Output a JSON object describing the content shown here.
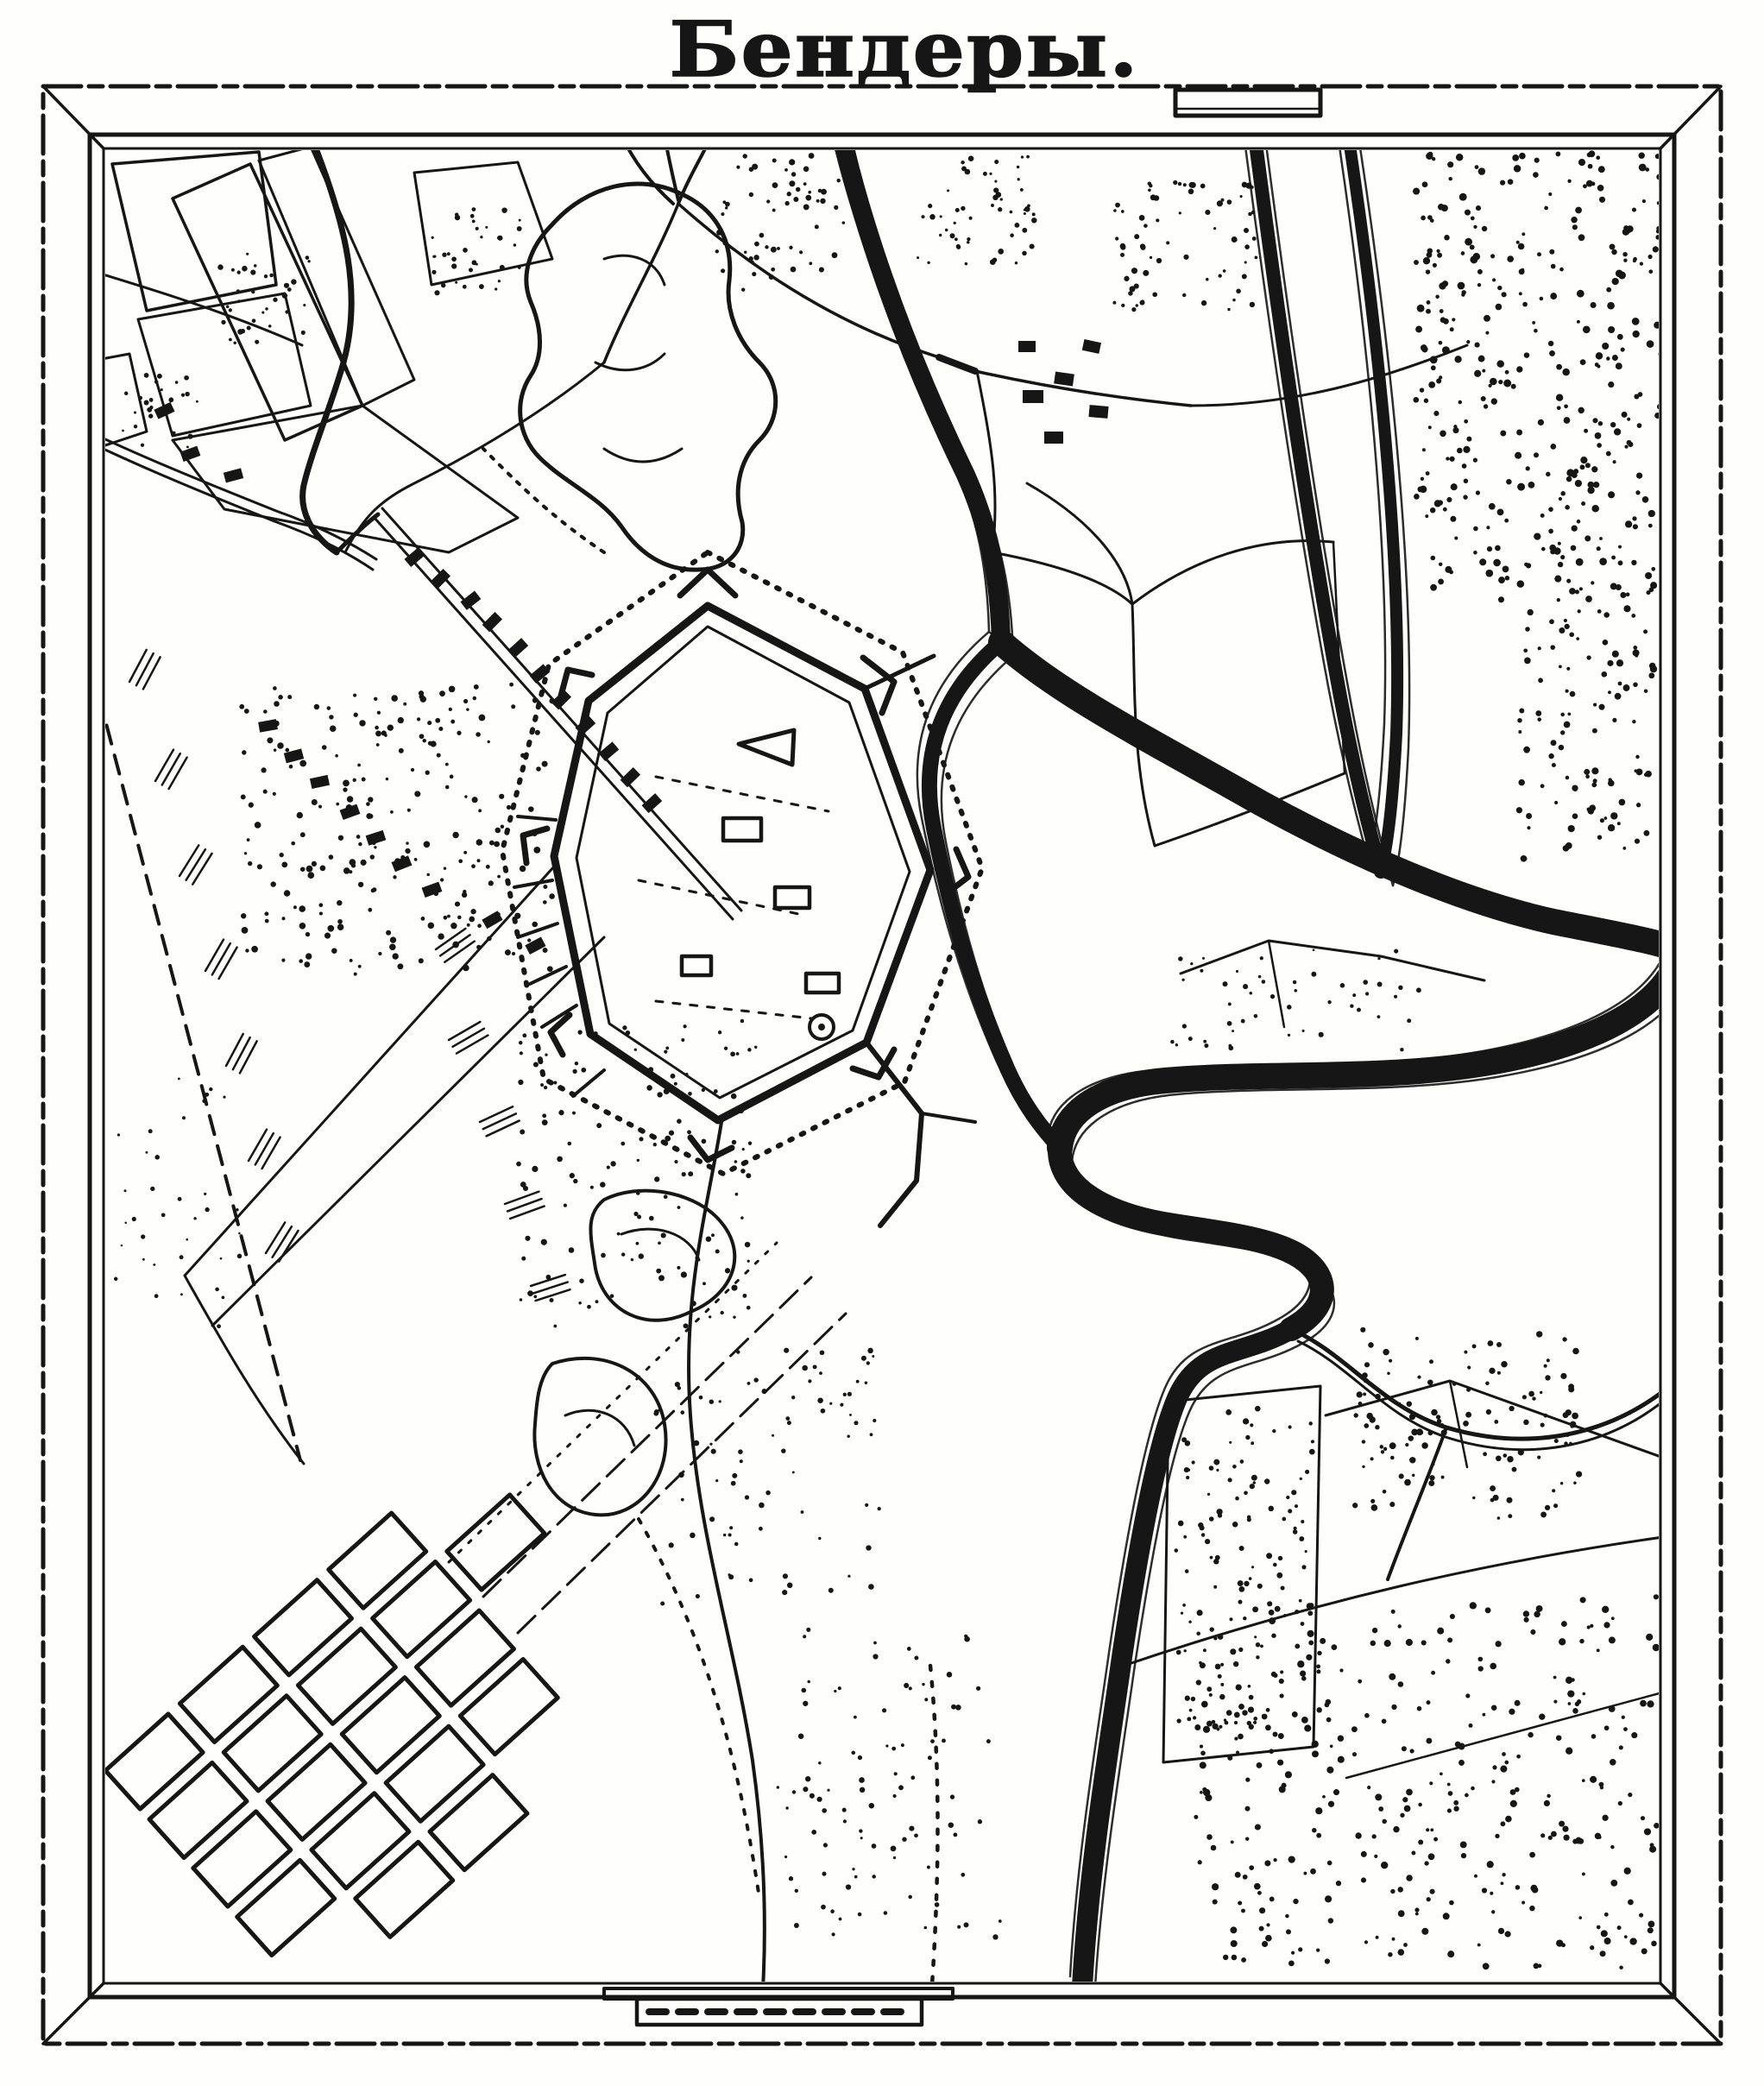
{
  "title": "Бендеры.",
  "page": {
    "paper": "#fefefc",
    "ink": "#161616"
  },
  "map": {
    "kind": "historic engraved fortress-town plan (black ink scan)",
    "subject": "Bendery fortress and town on the Dniester river",
    "features": [
      {
        "id": "map-frame",
        "label": "double-line picture frame with mitred corners"
      },
      {
        "id": "map-title",
        "label": "Бендеры."
      },
      {
        "id": "title-cartouche-bar",
        "label": "double-line bar right of title"
      },
      {
        "id": "river-dniester",
        "label": "Dniester river: main arm, twin channels, S-meander"
      },
      {
        "id": "stream-east",
        "label": "small winding stream to east edge"
      },
      {
        "id": "fortress",
        "label": "pentagonal bastioned fortress with covered way and glacis"
      },
      {
        "id": "fortress-buildings",
        "label": "buildings inside fortress"
      },
      {
        "id": "suburb-west",
        "label": "western suburb houses and ruins"
      },
      {
        "id": "suburb-northeast",
        "label": "riverside hamlet north-east of fortress"
      },
      {
        "id": "fields-northwest",
        "label": "field parcels north-west"
      },
      {
        "id": "fields-east",
        "label": "field parcels along river"
      },
      {
        "id": "fields-southeast",
        "label": "field parcels south-east"
      },
      {
        "id": "ravine-gardens",
        "label": "garden/ravine blobs"
      },
      {
        "id": "woods-stipple",
        "label": "stippled woods, orchards and vineyards"
      },
      {
        "id": "town-grid",
        "label": "rotated rectangular blocks of the new town"
      },
      {
        "id": "roads",
        "label": "roads, tracks and dashed routes"
      },
      {
        "id": "contour-marks",
        "label": "short hachure/contour dashes"
      },
      {
        "id": "south-causeway",
        "label": "causeway stub crossing bottom frame"
      }
    ]
  }
}
